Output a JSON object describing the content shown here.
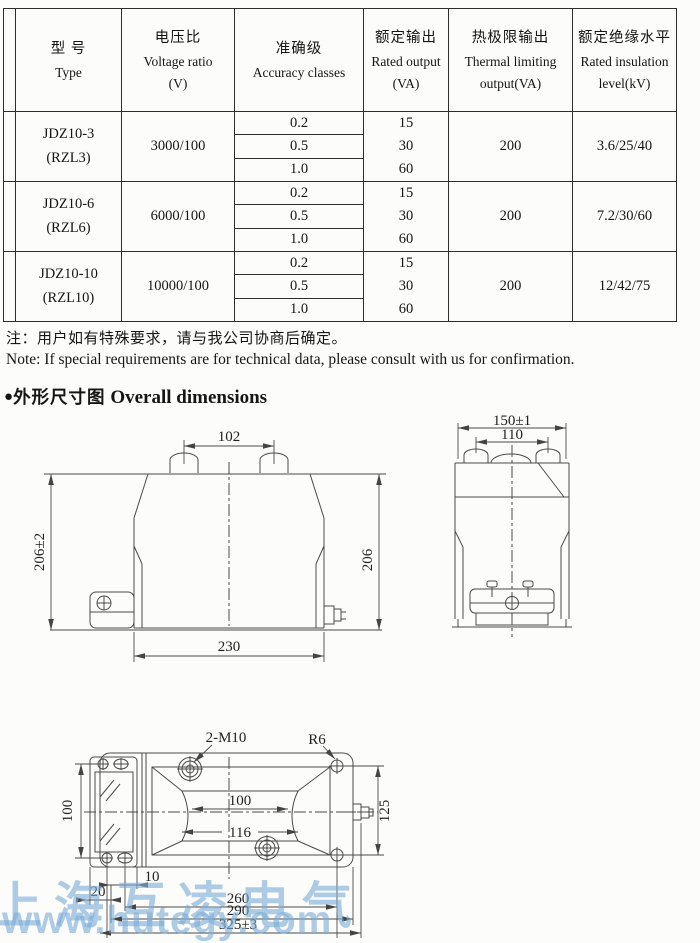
{
  "table": {
    "headers": [
      {
        "lines": [
          "型  号",
          "Type"
        ]
      },
      {
        "lines": [
          "电压比",
          "Voltage ratio",
          "(V)"
        ]
      },
      {
        "lines": [
          "准确级",
          "Accuracy classes"
        ]
      },
      {
        "lines": [
          "额定输出",
          "Rated output",
          "(VA)"
        ]
      },
      {
        "lines": [
          "热极限输出",
          "Thermal limiting",
          "output(VA)"
        ]
      },
      {
        "lines": [
          "额定绝缘水平",
          "Rated insulation",
          "level(kV)"
        ]
      }
    ],
    "rows": [
      {
        "type": [
          "JDZ10-3",
          "(RZL3)"
        ],
        "ratio": "3000/100",
        "accuracy": [
          "0.2",
          "0.5",
          "1.0"
        ],
        "output": [
          "15",
          "30",
          "60"
        ],
        "thermal": "200",
        "insulation": "3.6/25/40"
      },
      {
        "type": [
          "JDZ10-6",
          "(RZL6)"
        ],
        "ratio": "6000/100",
        "accuracy": [
          "0.2",
          "0.5",
          "1.0"
        ],
        "output": [
          "15",
          "30",
          "60"
        ],
        "thermal": "200",
        "insulation": "7.2/30/60"
      },
      {
        "type": [
          "JDZ10-10",
          "(RZL10)"
        ],
        "ratio": "10000/100",
        "accuracy": [
          "0.2",
          "0.5",
          "1.0"
        ],
        "output": [
          "15",
          "30",
          "60"
        ],
        "thermal": "200",
        "insulation": "12/42/75"
      }
    ]
  },
  "notes": {
    "zh": "注：用户如有特殊要求，请与我公司协商后确定。",
    "en": "Note: If special requirements are for technical data, please consult with us for confirmation."
  },
  "section": {
    "bullet": "●",
    "zh": "外形尺寸图",
    "en": "Overall dimensions"
  },
  "drawings": {
    "front": {
      "dim_top": "102",
      "dim_left": "206±2",
      "dim_right": "206",
      "dim_bottom": "230"
    },
    "side": {
      "dim_outer": "150±1",
      "dim_inner": "110"
    },
    "top": {
      "thread_label": "2-M10",
      "corner_radius": "R6",
      "window_width": "100",
      "window_outer_width": "116",
      "left_height": "100",
      "right_height": "125",
      "dim_10": "10",
      "dim_20": "20",
      "dim_260": "260",
      "dim_290": "290",
      "dim_overall": "325±3"
    }
  },
  "watermark": {
    "line1": "上海互凌电气",
    "line2": "www.hutegy.com",
    "color": "#7dacd5"
  }
}
